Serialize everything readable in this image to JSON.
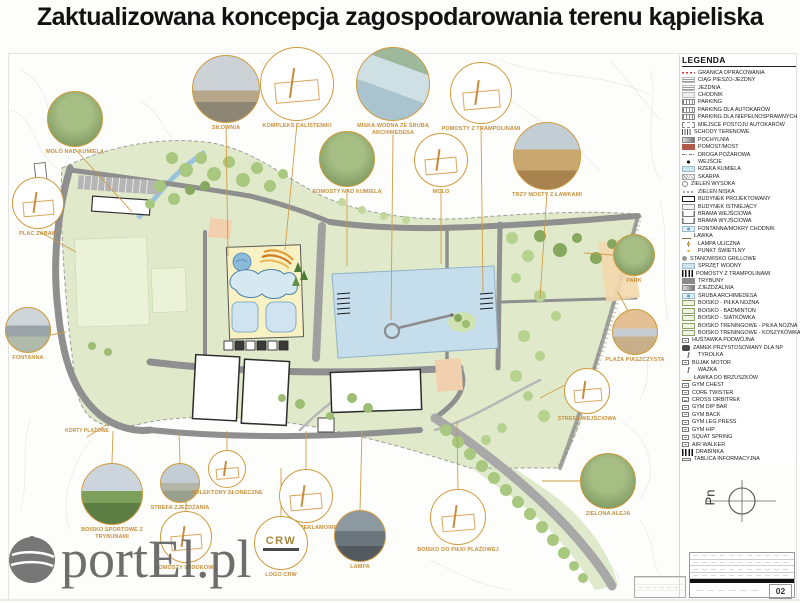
{
  "title": "Zaktualizowana koncepcja zagospodarowania terenu kąpieliska",
  "watermark": {
    "text": "portEl.pl"
  },
  "north": {
    "label": "Pn"
  },
  "sheet": {
    "page_number": "02"
  },
  "crw_label": "CRW",
  "colors": {
    "accent_orange": "#cf9a3c",
    "site_green": "#e0eacb",
    "lake_blue": "#c6ddec",
    "sand_yellow": "#f8f1c4",
    "road_gray": "#969696",
    "boundary_red": "#c0392b",
    "watermark_gray": "#676767"
  },
  "plan_labels": [
    {
      "label": "KORTY PLAŻOWE",
      "x": 57,
      "y": 428
    }
  ],
  "legend": {
    "title": "LEGENDA",
    "items": [
      {
        "label": "GRANICA OPRACOWANIA",
        "icon": "dashred"
      },
      {
        "label": "CIĄG PIESZO-JEZDNY",
        "icon": "lines"
      },
      {
        "label": "JEZDNIA",
        "icon": "lines"
      },
      {
        "label": "CHODNIK",
        "icon": "walk"
      },
      {
        "label": "PARKING",
        "icon": "park"
      },
      {
        "label": "PARKING DLA AUTOKARÓW",
        "icon": "park"
      },
      {
        "label": "PARKING DLA NIEPEŁNOSPRAWNYCH",
        "icon": "park"
      },
      {
        "label": "MIEJSCE POSTOJU AUTOKARÓW",
        "icon": "dashbox"
      },
      {
        "label": "SCHODY TERENOWE",
        "icon": "steps"
      },
      {
        "label": "POCHYLNIA",
        "icon": "ramp"
      },
      {
        "label": "POMOST/MOST",
        "icon": "bridge"
      },
      {
        "label": "DROGA POŻAROWA",
        "icon": "dashdot"
      },
      {
        "label": "WEJŚCIE",
        "icon": "entry"
      },
      {
        "label": "RZEKA KUMIELA",
        "icon": "river"
      },
      {
        "label": "SKARPA",
        "icon": "scarp"
      },
      {
        "label": "ZIELEŃ WYSOKA",
        "icon": "treehi"
      },
      {
        "label": "ZIELEŃ NISKA",
        "icon": "treelo"
      },
      {
        "label": "BUDYNEK PROJEKTOWANY",
        "icon": "bldgnew"
      },
      {
        "label": "BUDYNEK ISTNIEJĄCY",
        "icon": "bldgold"
      },
      {
        "label": "BRAMA WEJŚCIOWA",
        "icon": "gate"
      },
      {
        "label": "BRAMA WYJŚCIOWA",
        "icon": "gate"
      },
      {
        "label": "FONTANNA/MOKRY CHODNIK",
        "icon": "fountain"
      },
      {
        "label": "ŁAWKA",
        "icon": "bench"
      },
      {
        "label": "LAMPA ULICZNA",
        "icon": "lamp"
      },
      {
        "label": "PUNKT ŚWIETLNY",
        "icon": "light"
      },
      {
        "label": "STANOWISKO GRILLOWE",
        "icon": "grill"
      },
      {
        "label": "SPRZĘT WODNY",
        "icon": "river"
      },
      {
        "label": "POMOSTY Z TRAMPOLINAMI",
        "icon": "tramp"
      },
      {
        "label": "TRYBUNY",
        "icon": "stands"
      },
      {
        "label": "ZJEŻDŻALNIA",
        "icon": "ramp"
      },
      {
        "label": "ŚRUBA ARCHIMEDESA",
        "icon": "fountain"
      },
      {
        "label": "BOISKO - PIŁKA NOŻNA",
        "icon": "court"
      },
      {
        "label": "BOISKO - BADMINTON",
        "icon": "court"
      },
      {
        "label": "BOISKO - SIATKÓWKA",
        "icon": "court"
      },
      {
        "label": "BOISKO TRENINGOWE - PIŁKA NOŻNA",
        "icon": "court"
      },
      {
        "label": "BOISKO TRENINGOWE - KOSZYKÓWKA",
        "icon": "court"
      },
      {
        "label": "HUŚTAWKA PODWÓJNA",
        "icon": "gym"
      },
      {
        "label": "ZAMEK PRZYSTOSOWANY DLA NP",
        "icon": "blob"
      },
      {
        "label": "TYROLKA",
        "icon": "zip"
      },
      {
        "label": "BUJAK MOTOR",
        "icon": "gym"
      },
      {
        "label": "WAŻKA",
        "icon": "zip"
      },
      {
        "label": "ŁAWKA DO BRZUSZKÓW",
        "icon": "bench"
      },
      {
        "label": "GYM CHEST",
        "icon": "gym"
      },
      {
        "label": "CORE TWISTER",
        "icon": "gym"
      },
      {
        "label": "CROSS ORBITREK",
        "icon": "gym"
      },
      {
        "label": "GYM DIP BAR",
        "icon": "gym"
      },
      {
        "label": "GYM BACK",
        "icon": "gym"
      },
      {
        "label": "GYM LEG PRESS",
        "icon": "gym"
      },
      {
        "label": "GYM HIP",
        "icon": "gym"
      },
      {
        "label": "SQUAT SPRING",
        "icon": "gym"
      },
      {
        "label": "AIR WALKER",
        "icon": "gym"
      },
      {
        "label": "DRABINKA",
        "icon": "tramp"
      },
      {
        "label": "TABLICA INFORMACYJNA",
        "icon": "board"
      }
    ]
  },
  "callouts": [
    {
      "label": "SIŁOWNIA",
      "kind": "photo-deck",
      "x": 226,
      "y": 89,
      "r": 34
    },
    {
      "label": "KOMPLEKS CALISTENIKI",
      "kind": "sketch",
      "x": 297,
      "y": 84,
      "r": 37
    },
    {
      "label": "MISKA WODNA ZE ŚRUBĄ ARCHIMEDESA",
      "kind": "photo-water",
      "x": 393,
      "y": 84,
      "r": 37
    },
    {
      "label": "POMOSTY Z TRAMPOLINAMI",
      "kind": "sketch",
      "x": 481,
      "y": 93,
      "r": 31
    },
    {
      "label": "TRZY MOSTY Z ŁAWKAMI",
      "kind": "photo-boardwalk",
      "x": 547,
      "y": 156,
      "r": 34
    },
    {
      "label": "MOLO NAD KUMIELĄ",
      "kind": "photo-green",
      "x": 75,
      "y": 119,
      "r": 28
    },
    {
      "label": "PLAC ZABAW",
      "kind": "sketch",
      "x": 38,
      "y": 203,
      "r": 26
    },
    {
      "label": "FONTANNA",
      "kind": "photo-gray",
      "x": 28,
      "y": 330,
      "r": 23
    },
    {
      "label": "POMOSTY NAD KUMIELĄ",
      "kind": "photo-green",
      "x": 347,
      "y": 159,
      "r": 28
    },
    {
      "label": "MOLO",
      "kind": "sketch",
      "x": 441,
      "y": 160,
      "r": 27
    },
    {
      "label": "PARK",
      "kind": "photo-green",
      "x": 634,
      "y": 255,
      "r": 21
    },
    {
      "label": "PLAŻA PIASZCZYSTA",
      "kind": "photo-beach",
      "x": 635,
      "y": 332,
      "r": 23
    },
    {
      "label": "STREFA WEJŚCIOWA",
      "kind": "sketch",
      "x": 587,
      "y": 391,
      "r": 23
    },
    {
      "label": "BOISKO SPORTOWE Z TRYBUNAMI",
      "kind": "photo-stadium",
      "x": 112,
      "y": 494,
      "r": 31
    },
    {
      "label": "STREFA ZJEŻDŻANIA",
      "kind": "photo-city",
      "x": 180,
      "y": 483,
      "r": 20
    },
    {
      "label": "KOLEKTORY SŁONECZNE",
      "kind": "sketch",
      "x": 227,
      "y": 469,
      "r": 19
    },
    {
      "label": "POMOSTY WIDOKOWE",
      "kind": "sketch",
      "x": 186,
      "y": 537,
      "r": 26
    },
    {
      "label": "PYLONY REKLAMOWE",
      "kind": "sketch",
      "x": 306,
      "y": 496,
      "r": 27
    },
    {
      "label": "LOGO CRW",
      "kind": "logo",
      "x": 281,
      "y": 543,
      "r": 27
    },
    {
      "label": "LAMPA",
      "kind": "photo-night",
      "x": 360,
      "y": 536,
      "r": 26
    },
    {
      "label": "BOISKO DO PIŁKI PLAŻOWEJ",
      "kind": "sketch",
      "x": 458,
      "y": 517,
      "r": 28
    },
    {
      "label": "ZIELONA ALEJA",
      "kind": "photo-green",
      "x": 608,
      "y": 481,
      "r": 28
    }
  ]
}
